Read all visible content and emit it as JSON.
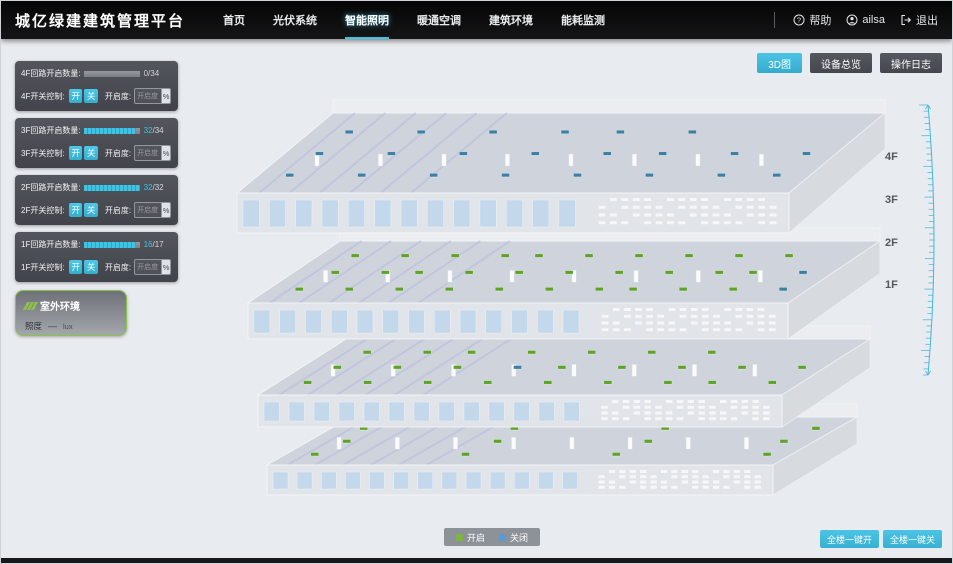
{
  "header": {
    "title": "城亿绿建建筑管理平台",
    "nav": {
      "items": [
        "首页",
        "光伏系统",
        "智能照明",
        "暖通空调",
        "建筑环境",
        "能耗监测"
      ],
      "active_index": 2
    },
    "help": "帮助",
    "user": "ailsa",
    "logout": "退出"
  },
  "toolbar": {
    "view_3d": "3D图",
    "device_overview": "设备总览",
    "operation_log": "操作日志"
  },
  "panels": [
    {
      "floor": "4F",
      "circuit_label": "4F回路开启数量:",
      "count": "0",
      "total": "/34",
      "pct": 0,
      "count_color": "#c7cbd0",
      "switch_label": "4F开关控制:",
      "btn_on": "开",
      "btn_off": "关",
      "dim_label": "开启度:",
      "dim_placeholder": "开启度",
      "percent": "%"
    },
    {
      "floor": "3F",
      "circuit_label": "3F回路开启数量:",
      "count": "32",
      "total": "/34",
      "pct": 94,
      "count_color": "#3fc2e4",
      "switch_label": "3F开关控制:",
      "btn_on": "开",
      "btn_off": "关",
      "dim_label": "开启度:",
      "dim_placeholder": "开启度",
      "percent": "%"
    },
    {
      "floor": "2F",
      "circuit_label": "2F回路开启数量:",
      "count": "32",
      "total": "/32",
      "pct": 100,
      "count_color": "#3fc2e4",
      "switch_label": "2F开关控制:",
      "btn_on": "开",
      "btn_off": "关",
      "dim_label": "开启度:",
      "dim_placeholder": "开启度",
      "percent": "%"
    },
    {
      "floor": "1F",
      "circuit_label": "1F回路开启数量:",
      "count": "16",
      "total": "/17",
      "pct": 94,
      "count_color": "#3fc2e4",
      "switch_label": "1F开关控制:",
      "btn_on": "开",
      "btn_off": "关",
      "dim_label": "开启度:",
      "dim_placeholder": "开启度",
      "percent": "%"
    }
  ],
  "outdoor": {
    "title": "室外环境",
    "metric": "照度",
    "value": "—",
    "unit": "lux"
  },
  "legend": {
    "on_label": "开启",
    "off_label": "关闭",
    "on_color": "#7cb342",
    "off_color": "#5b9bd5"
  },
  "actions": {
    "all_on": "全楼一键开",
    "all_off": "全楼一键关"
  },
  "floor_axis": [
    "4F",
    "3F",
    "2F",
    "1F"
  ],
  "building": {
    "floors": [
      {
        "label": "4F",
        "lights_on": 0,
        "lights_off": 22
      },
      {
        "label": "3F",
        "lights_on": 30,
        "lights_off": 2
      },
      {
        "label": "2F",
        "lights_on": 24,
        "lights_off": 1
      },
      {
        "label": "1F",
        "lights_on": 12,
        "lights_off": 0
      }
    ],
    "on_color": "#5da329",
    "off_color": "#3b7fa2"
  },
  "colors": {
    "accent": "#3fc2e4",
    "scale": "#41b8da"
  }
}
